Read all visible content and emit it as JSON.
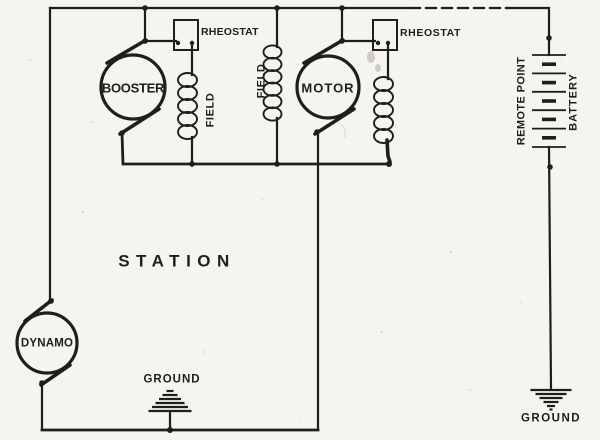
{
  "colors": {
    "ink": "#201e1b",
    "paper": "#f5f4ef"
  },
  "labels": {
    "station": "STATION",
    "booster": "BOOSTER",
    "motor": "MOTOR",
    "dynamo": "DYNAMO",
    "rheostat_booster": "RHEOSTAT",
    "rheostat_motor": "RHEOSTAT",
    "field_booster": "FIELD",
    "field_main": "FIELD",
    "remote_point": "REMOTE POINT",
    "battery": "BATTERY",
    "ground_station": "GROUND",
    "ground_remote": "GROUND"
  }
}
